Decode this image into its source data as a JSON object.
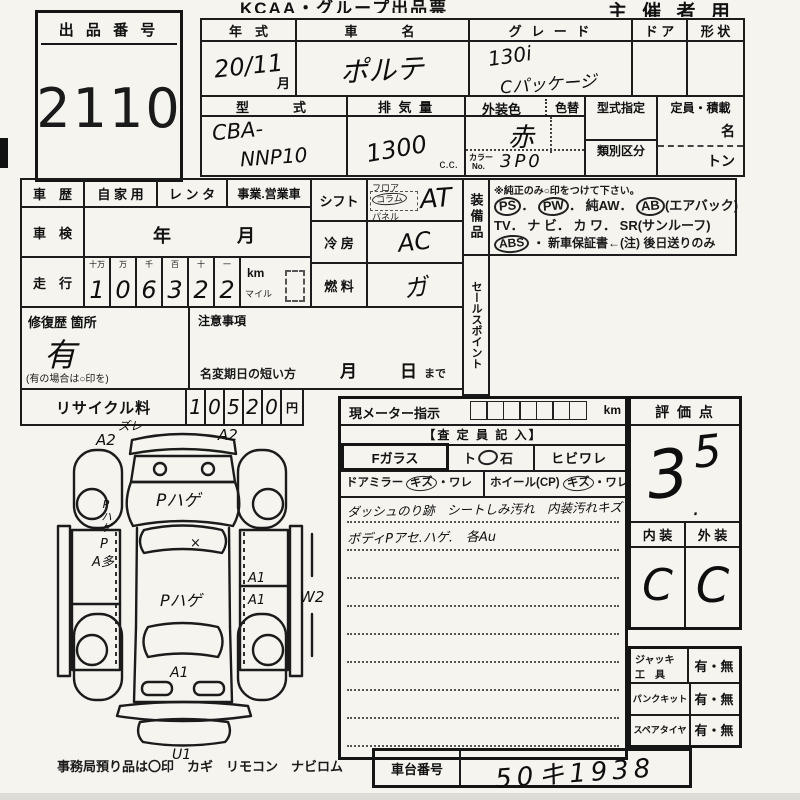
{
  "header": {
    "title": "KCAA・グループ出品票",
    "right": "主 催 者 用"
  },
  "lot": {
    "label": "出 品 番 号",
    "number": "2110"
  },
  "top": {
    "year_label": "年　式",
    "year_value": "20/11",
    "month": "月",
    "name_label": "車　　名",
    "name_value": "ポルテ",
    "grade_label": "グ レ ー ド",
    "grade1": "130i",
    "grade2": "Cパッケージ",
    "door_label": "ド ア",
    "shape_label": "形 状",
    "model_label": "型　　式",
    "model1": "CBA-",
    "model2": "NNP10",
    "disp_label": "排 気 量",
    "disp_value": "1300",
    "disp_unit": "c.c.",
    "color_label": "外装色",
    "color_change": "色替",
    "color_value": "赤",
    "color_no_l1": "カラー",
    "color_no_l2": "No.",
    "color_no": "3P0",
    "type_desig": "型式指定",
    "class_div": "類別区分",
    "capacity": "定員・積載",
    "persons": "名",
    "tons": "トン"
  },
  "history": {
    "label": "車　歴",
    "opt1": "自 家 用",
    "opt2": "レ ン タ",
    "opt3": "事業.営業車",
    "shaken_label": "車　検",
    "year": "年",
    "month": "月",
    "mileage_label": "走　行",
    "digit_labels": [
      "十万",
      "万",
      "千",
      "百",
      "十",
      "一"
    ],
    "digits": [
      "1",
      "0",
      "6",
      "3",
      "2",
      "2"
    ],
    "km": "km",
    "mile": "マイル"
  },
  "shift": {
    "label": "シフト",
    "floor": "フロア",
    "column": "コラム",
    "panel": "パネル",
    "value": "AT"
  },
  "cooling": {
    "label": "冷 房",
    "value": "AC"
  },
  "fuel": {
    "label": "燃 料",
    "value": "ガ"
  },
  "equip": {
    "vlabel": "装備品",
    "note": "※純正のみ○印をつけて下さい。",
    "ps": "PS",
    "dot1": "．",
    "pw": "PW",
    "dot2": "．",
    "aw": "純AW．",
    "ab": "AB",
    "airbag": "(エアバック)",
    "line2": "TV． ナ ビ． カ ワ． SR(サンルーフ)",
    "abs": "ABS",
    "line3rest": "・ 新車保証書←(注) 後日送りのみ"
  },
  "sales_point": "セールスポイント",
  "repair": {
    "label": "修復歴 箇所",
    "value": "有",
    "note": "(有の場合は○印を)"
  },
  "caution": {
    "label": "注意事項",
    "rename": "名変期日の短い方",
    "month": "月",
    "day": "日",
    "until": "まで"
  },
  "recycle": {
    "label": "リサイクル料",
    "digits": [
      "1",
      "0",
      "5",
      "2",
      "0"
    ],
    "yen": "円"
  },
  "meter": {
    "label": "現メーター指示",
    "km": "km",
    "inspector": "【査 定 員 記 入】",
    "glass": "Fガラス",
    "stone_a": "ト",
    "stone_b": "石",
    "crack": "ヒビワレ",
    "mirror": "ドアミラー",
    "kizu1": "キズ",
    "ware1": "・ワレ",
    "wheel": "ホイール(CP)",
    "kizu2": "キズ",
    "ware2": "・ワレ",
    "comment1": "ダッシュのり跡　シートしみ汚れ　内装汚れキズ",
    "comment2": "ボディPアセ.ハゲ.　各Au"
  },
  "rating": {
    "label": "評 価 点",
    "score": "3.5",
    "whole": "3",
    "point": ".",
    "frac": "5",
    "interior_label": "内 装",
    "exterior_label": "外 装",
    "interior": "C",
    "exterior": "C"
  },
  "tools": {
    "rows": [
      {
        "label1": "ジャッキ",
        "label2": "工　具",
        "value": "有・無"
      },
      {
        "label1": "パンクキット",
        "label2": "",
        "value": "有・無"
      },
      {
        "label1": "スペアタイヤ",
        "label2": "",
        "value": "有・無"
      }
    ]
  },
  "chassis": {
    "label": "車台番号",
    "value": "50キ1938"
  },
  "footer": {
    "note": "事務局預り品は〇印　カギ　リモコン　ナビロム"
  },
  "diagram": {
    "front_left_note": "ズレ",
    "front_left": "A2",
    "front_right": "A2",
    "left_fender": "Pハゲ",
    "hood": "Pハゲ",
    "windshield_x": "×",
    "left_door_p": "P",
    "left_door": "A多",
    "roof": "Pハゲ",
    "right_door1": "A1",
    "right_door2": "A1",
    "right_side": "W2",
    "tailgate": "A1",
    "rear_bumper": "U1"
  }
}
